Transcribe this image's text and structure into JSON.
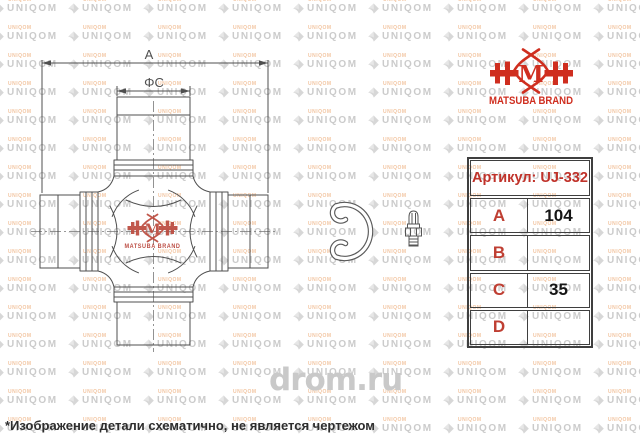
{
  "watermark": {
    "brand": "UNIQOM",
    "accent_text": "UNIQOM",
    "site": "drom.ru",
    "tile_color": "#cbcbcb",
    "accent_color": "#e89654"
  },
  "brand_logo": {
    "monogram": "M",
    "brand_line": "MATSUBA BRAND",
    "color": "#cf2e1f"
  },
  "drawing": {
    "dim_a_label": "A",
    "dim_c_label": "ΦC",
    "line_color": "#4f4f4f",
    "center_logo": {
      "monogram": "M",
      "brand_line": "MATSUBA BRAND",
      "color": "#bc4a3d"
    }
  },
  "spec_table": {
    "header": "Артикул: UJ-332",
    "accent_color": "#c0322a",
    "rows": [
      {
        "label": "A",
        "value": "104"
      },
      {
        "label": "B",
        "value": ""
      },
      {
        "label": "C",
        "value": "35"
      },
      {
        "label": "D",
        "value": ""
      }
    ]
  },
  "footnote": "*Изображение детали схематично, не является чертежом"
}
